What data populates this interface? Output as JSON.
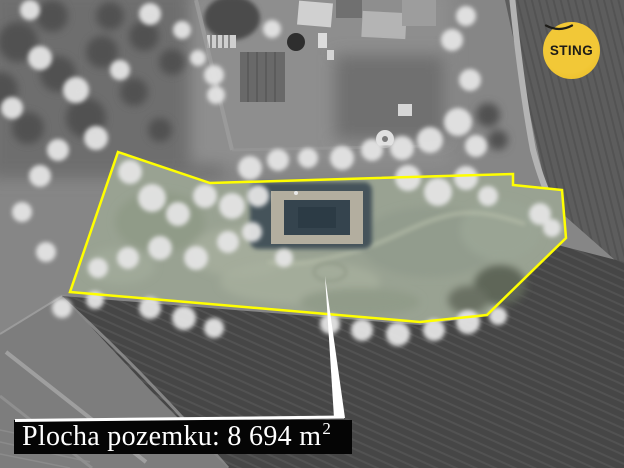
{
  "branding": {
    "logo_text": "STING",
    "badge_color": "#edbf2b"
  },
  "annotation": {
    "label_text": "Plocha pozemku: 8 694 m",
    "label_superscript": "2",
    "label_full": "Plocha pozemku: 8 694 m²",
    "area_value": "8 694",
    "area_unit": "m²",
    "outline_color": "#ffff00",
    "arrow_color": "#ffffff",
    "label_bg": "#050505",
    "label_text_color": "#ffffff"
  }
}
